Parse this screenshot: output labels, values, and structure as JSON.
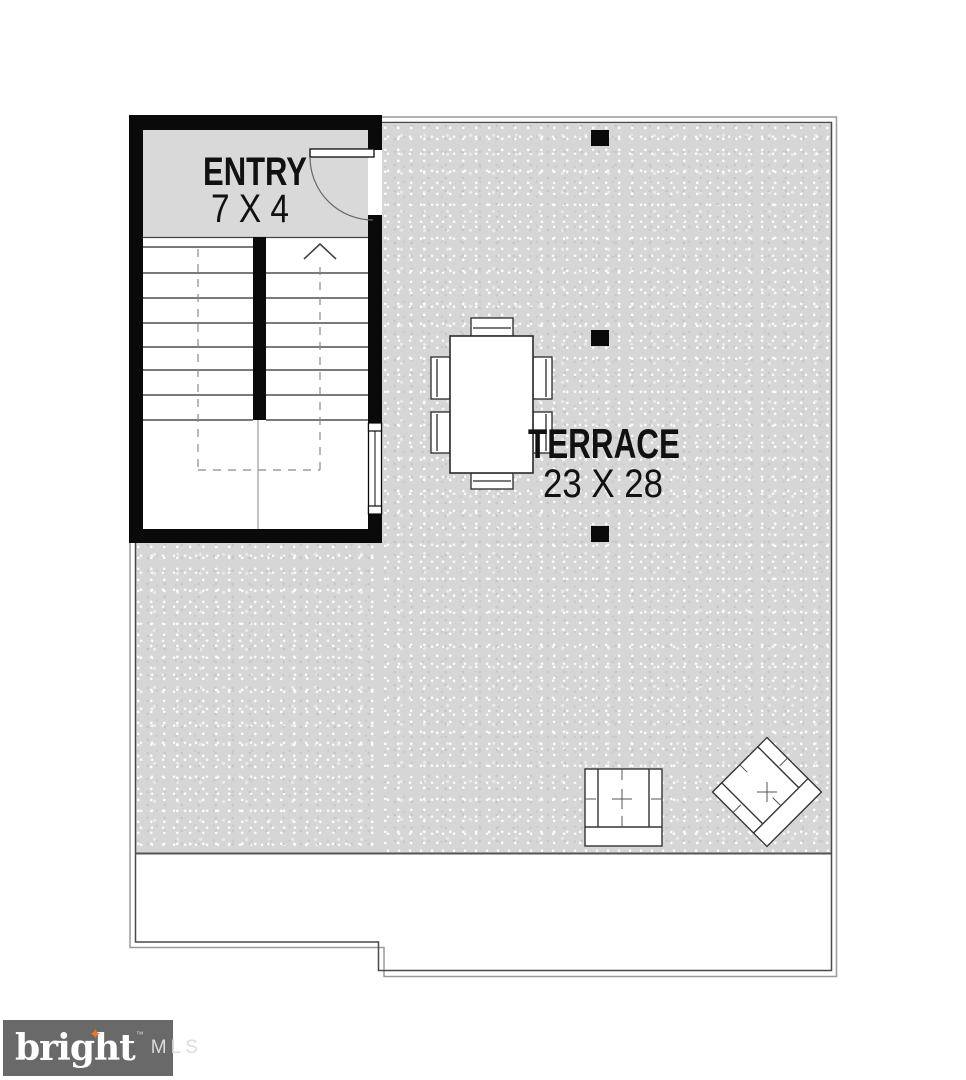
{
  "floorplan": {
    "entry": {
      "label": "ENTRY",
      "dimensions": "7 X 4"
    },
    "terrace": {
      "label": "TERRACE",
      "dimensions": "23 X 28"
    },
    "furniture": {
      "dining_chairs": 6,
      "armchairs": 2,
      "columns": 3
    }
  },
  "branding": {
    "name": "bright",
    "trademark": "™",
    "suffix": "MLS",
    "star_icon": "sparkle-icon",
    "background": "#696969",
    "star_color": "#e87a2e"
  },
  "colors": {
    "wall": "#0a0a0a",
    "entry_fill": "#d9d9d9",
    "terrace_fill": "#d6d6d6",
    "outline_inner": "#4a4a4a",
    "outline_outer": "#9a9a9a"
  }
}
